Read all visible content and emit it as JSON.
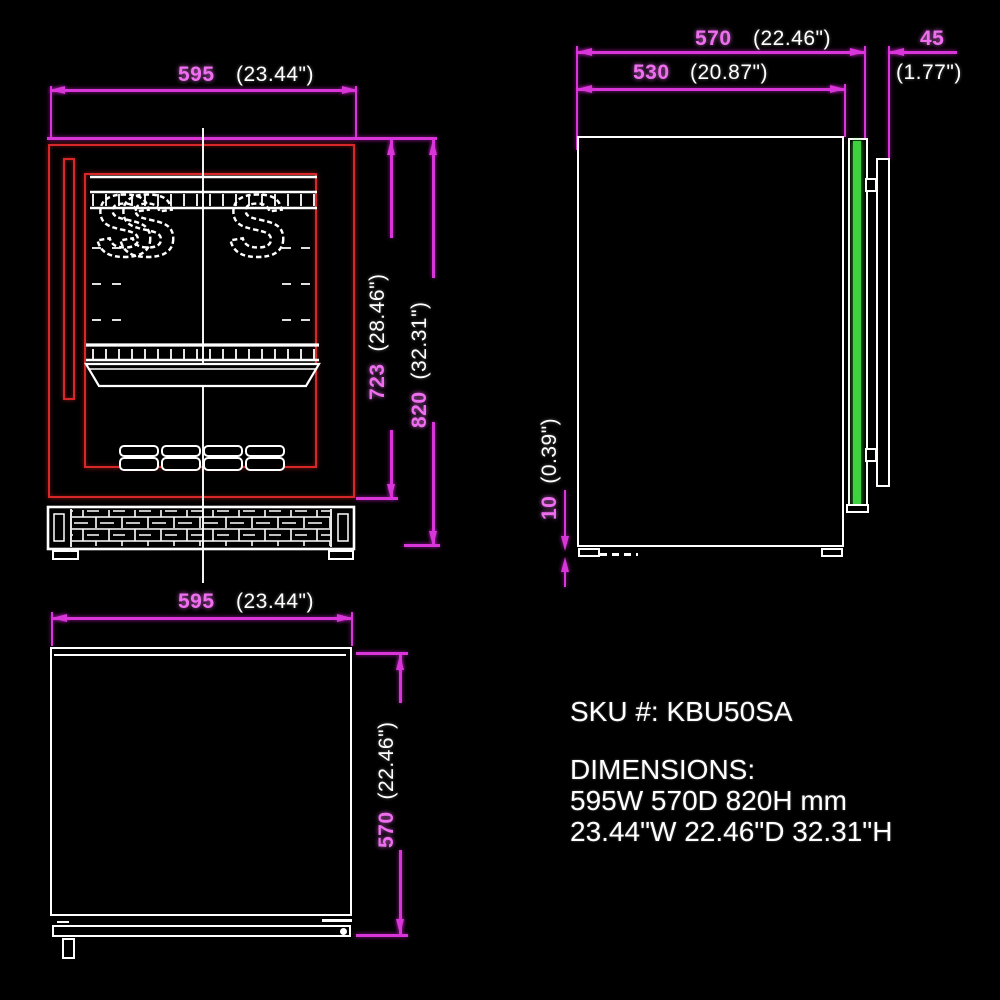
{
  "colors": {
    "magenta": "#d936d9",
    "dim_text": "#ee6fee",
    "red": "#d62828",
    "green": "#3fd23f",
    "white": "#ffffff",
    "background": "#000000"
  },
  "front_view": {
    "width_mm": "595",
    "width_in": "(23.44\")",
    "door_height_mm": "723",
    "door_height_in": "(28.46\")",
    "total_height_mm": "820",
    "total_height_in": "(32.31\")",
    "hook_glyph_1": "S",
    "hook_glyph_2": "S",
    "hook_glyph_3": "S"
  },
  "side_view": {
    "total_depth_mm": "570",
    "total_depth_in": "(22.46\")",
    "body_depth_mm": "530",
    "body_depth_in": "(20.87\")",
    "handle_depth_mm": "45",
    "handle_depth_in": "(1.77\")",
    "foot_height_mm": "10",
    "foot_height_in": "(0.39\")"
  },
  "top_view": {
    "width_mm": "595",
    "width_in": "(23.44\")",
    "depth_mm": "570",
    "depth_in": "(22.46\")"
  },
  "info": {
    "sku": "SKU #: KBU50SA",
    "dimensions_heading": "DIMENSIONS:",
    "dimensions_metric": "595W 570D 820H mm",
    "dimensions_imperial": "23.44\"W 22.46\"D 32.31\"H"
  }
}
